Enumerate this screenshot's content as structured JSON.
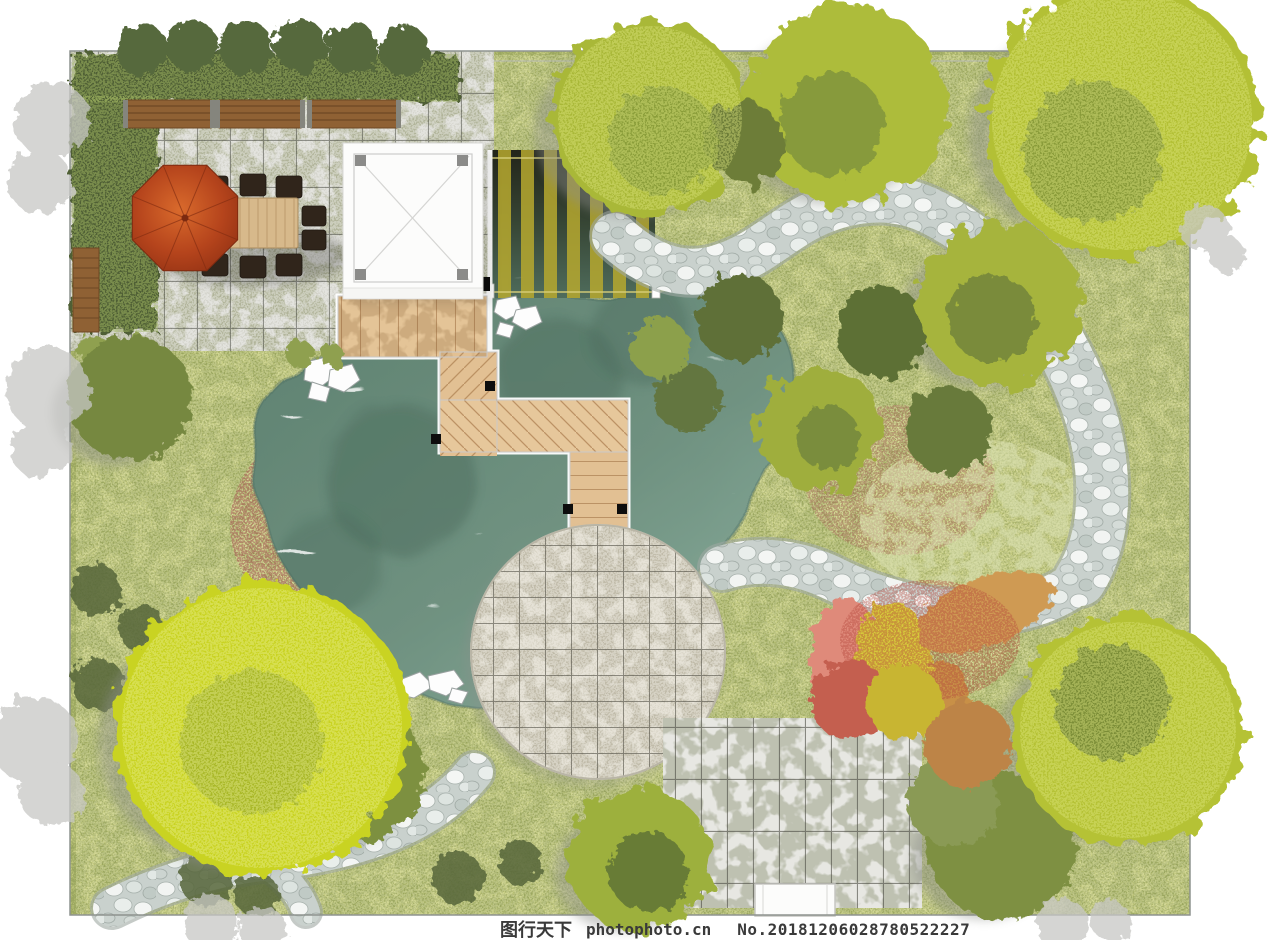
{
  "watermark": {
    "brand": "图行天下",
    "site": "photophoto.cn",
    "serial": "No.20181206028780522227"
  },
  "palette": {
    "paper": "#ffffff",
    "ink": "#3a3a3a",
    "grass": "#c7cd83",
    "water": "#6f9180",
    "water_deep": "#4b6b5c",
    "patio_stone": "#d5d5cd",
    "plaza_stone": "#dad6c8",
    "terrace_stone": "#e7e7e2",
    "pebble": "#c9d1cd",
    "deck_wood": "#e4c497",
    "bench_wood": "#8f6134",
    "umbrella": "#c2521f",
    "table_wood": "#d7b98b",
    "hedge": "#4f5f36",
    "tree_bright": "#c9d323",
    "tree_mid": "#a9b838",
    "tree_olive": "#78883c",
    "flower_pink": "#df8a7a",
    "flower_yellow": "#d6c93b",
    "flower_orange": "#cf9a52",
    "pavilion": "#fcfcfb",
    "slat": "#b7a92f"
  }
}
